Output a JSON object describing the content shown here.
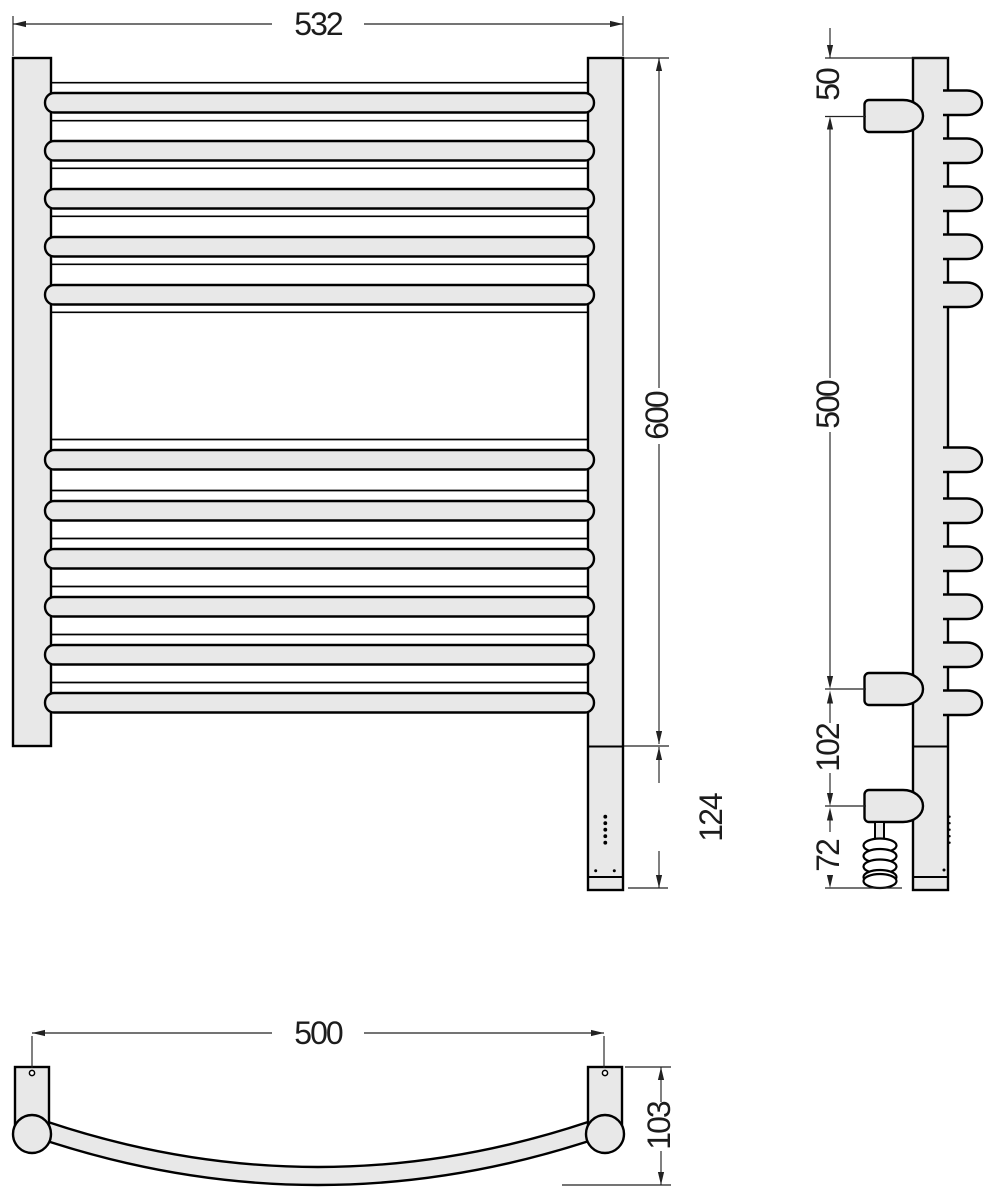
{
  "drawing": {
    "type": "technical-drawing",
    "subject": "ladder-towel-rail-three-views",
    "line_color": "#000000",
    "fill_color": "#e8e8e8",
    "views": {
      "front": {
        "width_mm": "532",
        "height_mm": "600",
        "lower_section_mm": "124"
      },
      "side": {
        "top_to_bracket_mm": "50",
        "bracket_span_mm": "500",
        "bracket_to_heater_mm": "102",
        "heater_to_bottom_mm": "72"
      },
      "top": {
        "mount_span_mm": "500",
        "depth_mm": "103"
      }
    }
  }
}
